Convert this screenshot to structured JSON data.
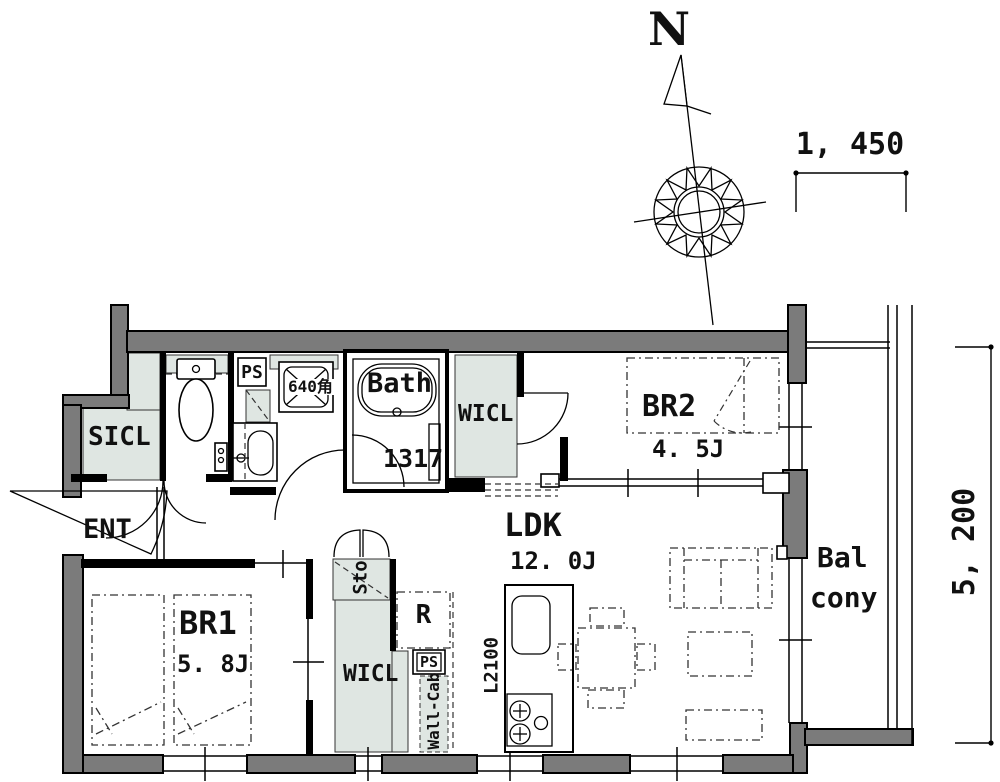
{
  "title": "apartment floor plan",
  "colors": {
    "wall_fill": "#7b7b7b",
    "closet_shade": "#dfe6e2",
    "line": "#000000",
    "background": "#ffffff"
  },
  "icons": {
    "compass": "compass-rose-icon",
    "north_needle": "north-needle-icon",
    "toilet": "toilet-icon",
    "bathtub": "bathtub-icon",
    "sink": "kitchen-sink-icon",
    "stove": "stove-burners-icon"
  },
  "compass": {
    "north_label": "N"
  },
  "dimensions": {
    "top_width": "1, 450",
    "right_height": "5, 200"
  },
  "rooms": {
    "entrance": {
      "label": "ENT"
    },
    "shoe_closet": {
      "label": "SICL"
    },
    "pipe_space_upper": {
      "label": "PS"
    },
    "washing_machine": {
      "label": "640角"
    },
    "bathroom": {
      "label": "Bath",
      "size": "1317"
    },
    "walk_in_closet_upper": {
      "label": "WICL"
    },
    "bedroom2": {
      "label": "BR2",
      "size": "4. 5J"
    },
    "living_dining_kitchen": {
      "label": "LDK",
      "size": "12. 0J",
      "counter_length": "L2100"
    },
    "bedroom1": {
      "label": "BR1",
      "size": "5. 8J"
    },
    "storage": {
      "label": "Sto"
    },
    "refrigerator_space": {
      "label": "R"
    },
    "pipe_space_lower": {
      "label": "PS"
    },
    "wall_cabinet": {
      "label": "Wall-Cab"
    },
    "walk_in_closet_lower": {
      "label": "WICL"
    },
    "balcony": {
      "label_line1": "Bal",
      "label_line2": "cony"
    }
  }
}
